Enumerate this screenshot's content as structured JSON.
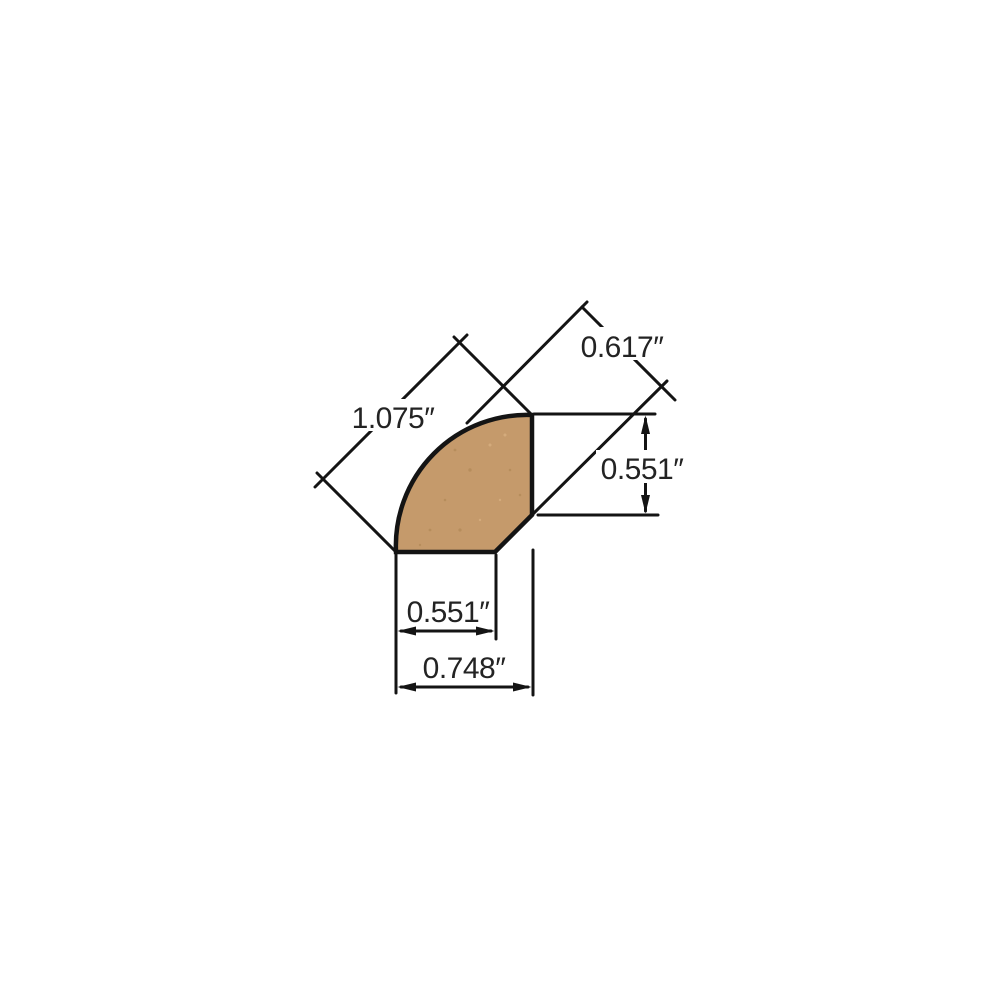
{
  "diagram": {
    "colors": {
      "line": "#141414",
      "text": "#232323",
      "wood_fill": "#c59a6b",
      "wood_speckle_dark": "#a9814f",
      "wood_speckle_light": "#e3bd8e",
      "background": "#ffffff"
    },
    "shape": {
      "name": "quarter-round-molding-profile"
    },
    "dimensions": {
      "diagonal_overall": {
        "label": "1.075″"
      },
      "diagonal_top": {
        "label": "0.617″"
      },
      "right_height": {
        "label": "0.551″"
      },
      "bottom_inner": {
        "label": "0.551″"
      },
      "bottom_overall": {
        "label": "0.748″"
      }
    }
  }
}
